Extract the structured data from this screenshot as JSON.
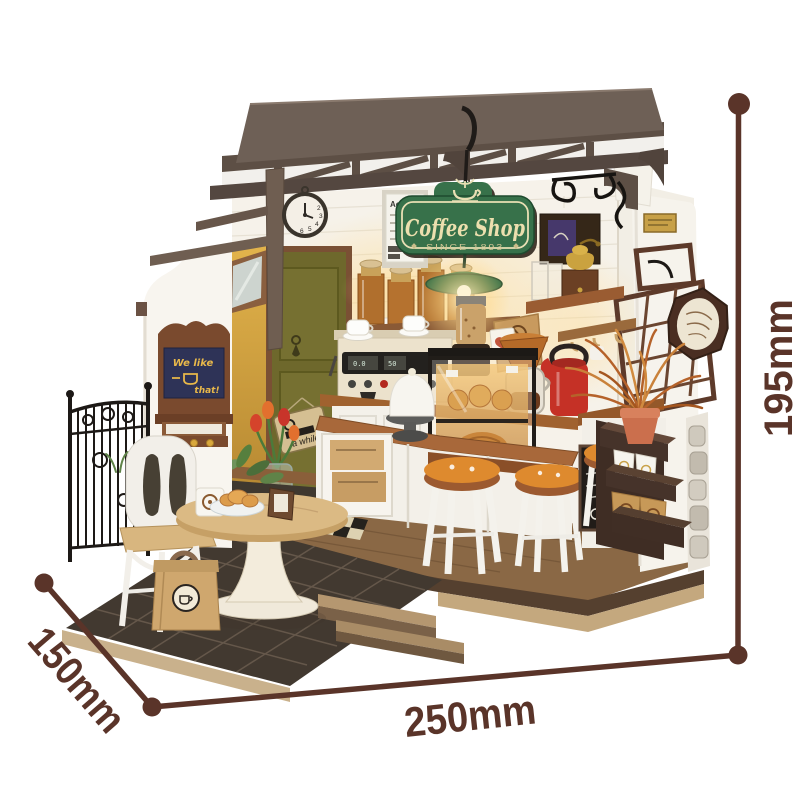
{
  "background": "#ffffff",
  "annotation": {
    "color": "#5a3429",
    "height": "195mm",
    "width": "250mm",
    "depth": "150mm"
  },
  "sign": {
    "title": "Coffee Shop",
    "subtitle": "SINCE 1893"
  },
  "chalkboard": {
    "line1": "We like",
    "line2": "that!"
  },
  "door_sign": {
    "text": "a while"
  },
  "beans_card": {
    "text": "Coffee Beans"
  },
  "wall_card": {
    "text": "Aci"
  },
  "espresso_machine": {
    "display_left": "0.0",
    "display_right": "50"
  },
  "clock": {
    "numerals": [
      "2",
      "3",
      "4",
      "5",
      "6"
    ]
  },
  "palette": {
    "roof_brown": "#5d4f45",
    "sign_green": "#37714a",
    "door_olive": "#6e682c",
    "counter_wood": "#a8683a",
    "stool_orange": "#de8a2e",
    "kettle_red": "#c53126",
    "patio_stone": "#423930",
    "base_wood": "#c4a87e",
    "chalk_navy": "#2e3357"
  }
}
